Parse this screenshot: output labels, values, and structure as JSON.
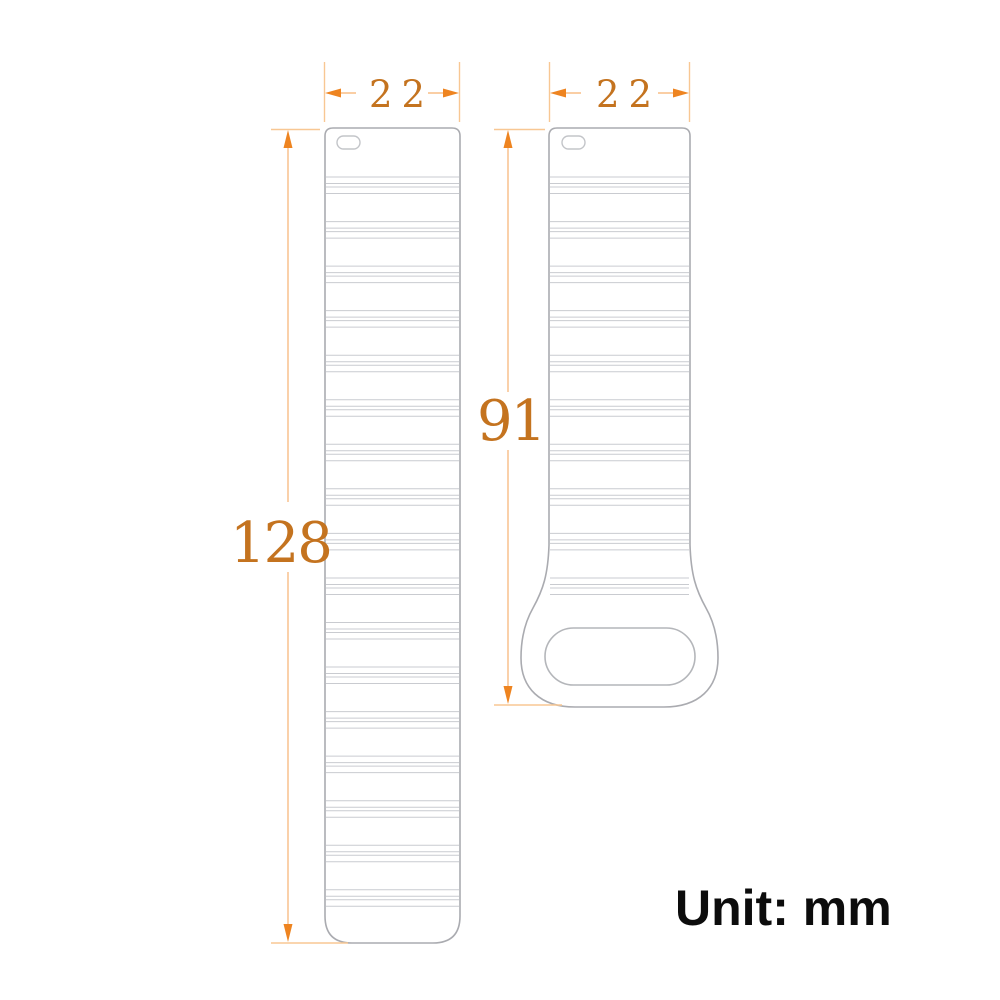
{
  "page": {
    "background": "#ffffff",
    "description": "Technical dimension drawing of a two-piece watch band (long tail strap and short buckle strap)"
  },
  "unit_note": "Unit: mm",
  "straps": {
    "left": {
      "name": "long-strap",
      "width_label": "22",
      "length_label": "128",
      "width_mm": 22,
      "length_mm": 128,
      "ridge_groups": 17,
      "features": [
        "spring-bar slot at top",
        "horizontal ridge groups",
        "rounded bottom end"
      ]
    },
    "right": {
      "name": "short-strap",
      "width_label": "22",
      "length_label": "91",
      "width_mm": 22,
      "length_mm": 91,
      "ridge_groups": 10,
      "features": [
        "spring-bar slot at top",
        "horizontal ridge groups",
        "flared loop end with stadium-shaped buckle hole"
      ]
    }
  },
  "colors": {
    "dimension_text": "#c4731f",
    "dimension_arrow": "#ee8420",
    "extension_line": "#f8c793",
    "strap_outline": "#aaabb0",
    "ridge_line": "#c9cbd0",
    "unit_text": "#0c0c0c",
    "background": "#ffffff"
  }
}
